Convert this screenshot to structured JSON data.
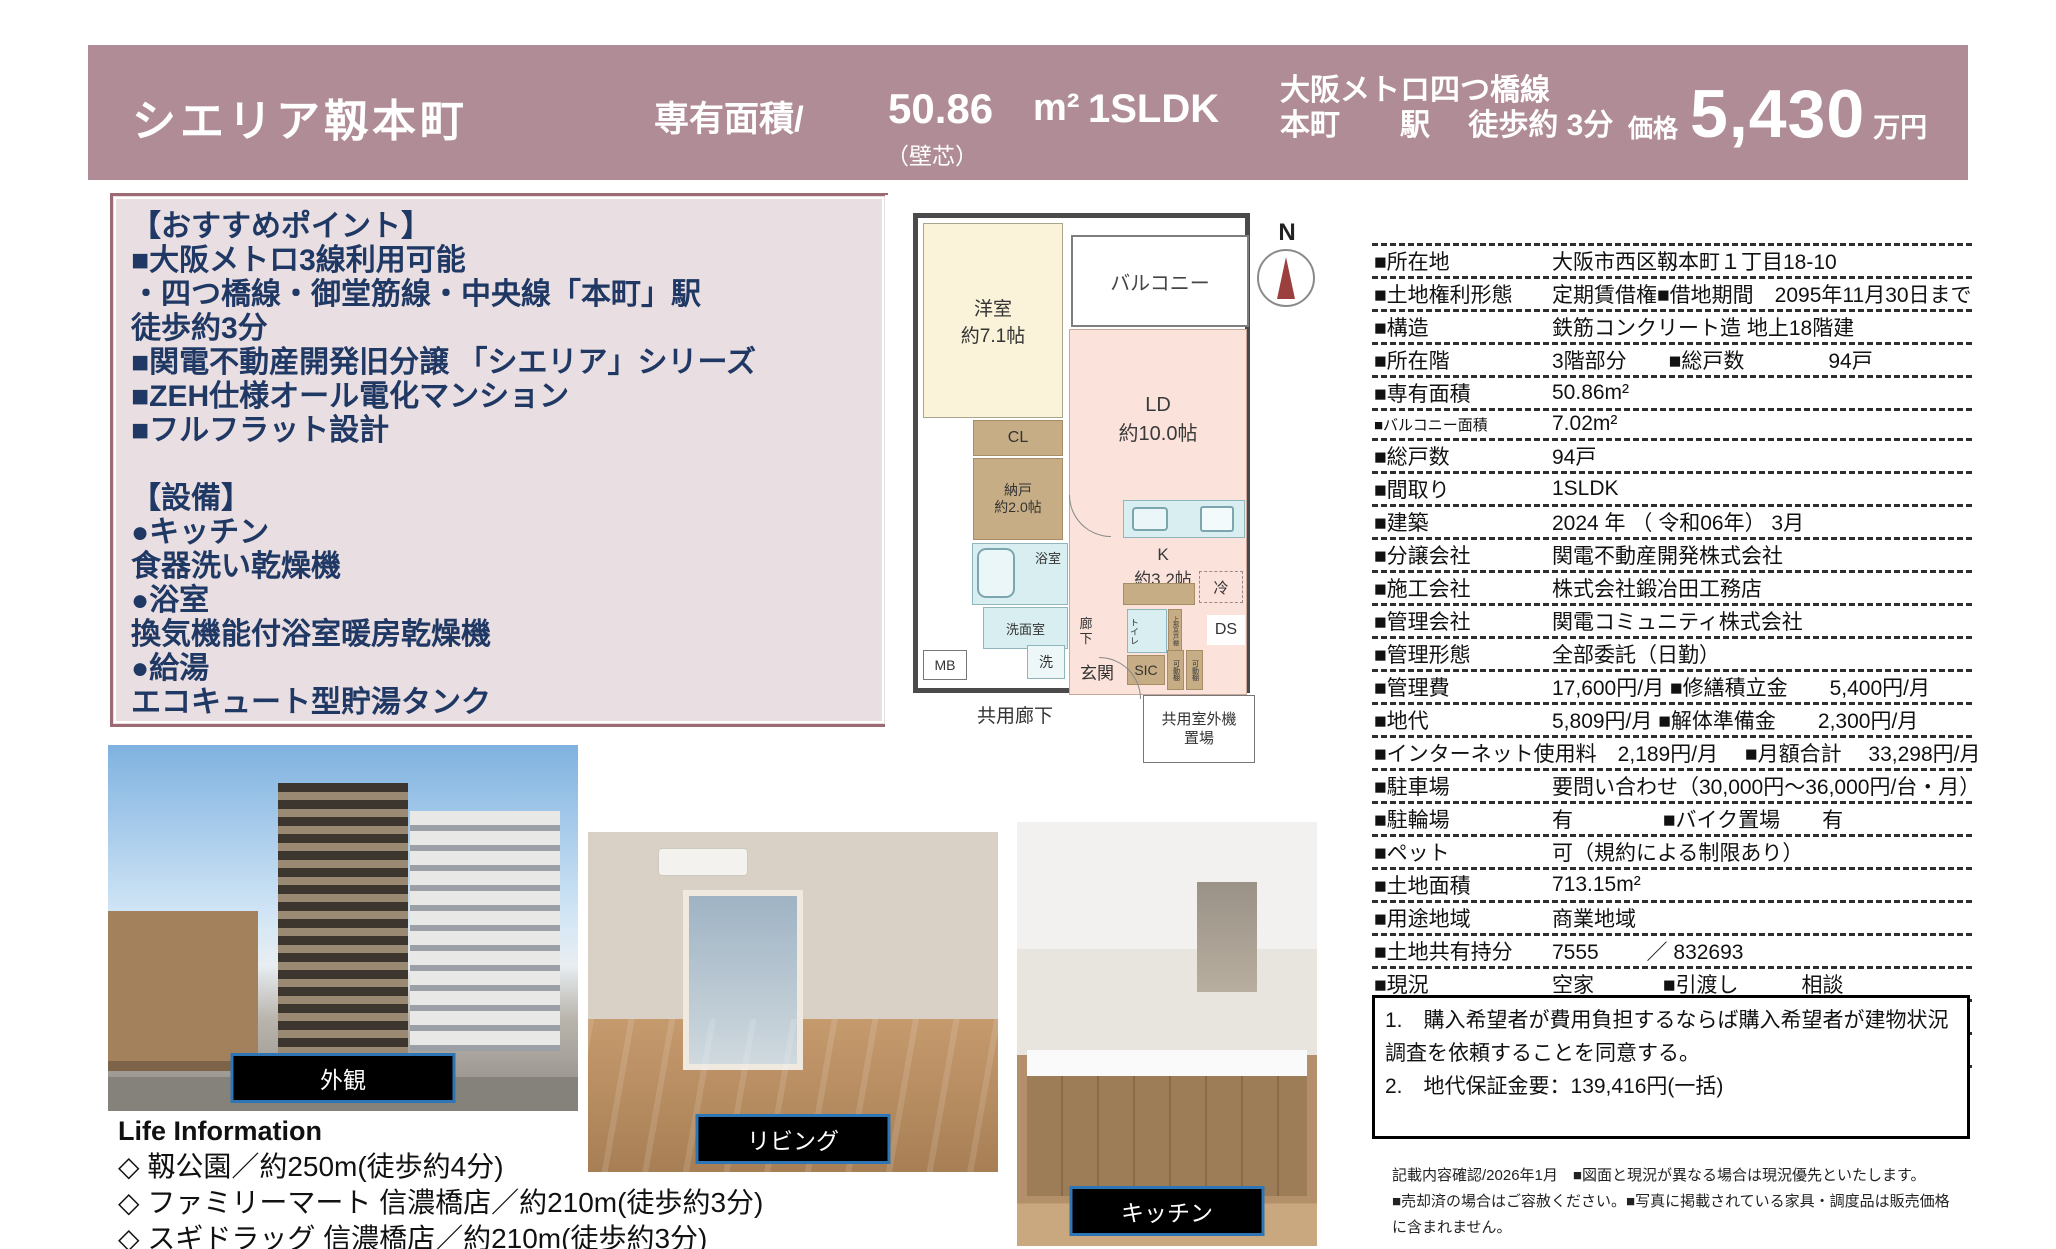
{
  "header": {
    "bg_color": "#b08d96",
    "title": "シエリア靱本町",
    "area_label": "専有面積/",
    "area_value": "50.86",
    "area_unit": "m²",
    "layout_type": "1SLDK",
    "area_note": "（壁芯）",
    "station_line1": "大阪メトロ四つ橋線",
    "station_line2": "本町　　駅　 徒歩約 3分",
    "price_label": "価格",
    "price_value": "5,430",
    "price_unit": "万円"
  },
  "highlights": {
    "lines": [
      "【おすすめポイント】",
      "■大阪メトロ3線利用可能",
      "・四つ橋線・御堂筋線・中央線「本町」駅",
      "徒歩約3分",
      "■関電不動産開発旧分譲 「シエリア」シリーズ",
      "■ZEH仕様オール電化マンション",
      "■フルフラット設計",
      "",
      "【設備】",
      "●キッチン",
      "食器洗い乾燥機",
      "●浴室",
      "換気機能付浴室暖房乾燥機",
      "●給湯",
      "エコキュート型貯湯タンク"
    ]
  },
  "floorplan": {
    "north_label": "N",
    "rooms": {
      "western_room": "洋室\n約7.1帖",
      "balcony": "バルコニー",
      "living_dining": "LD\n約10.0帖",
      "kitchen": "K\n約3.2帖",
      "fridge": "冷",
      "closet": "CL",
      "storage": "納戸\n約2.0帖",
      "bathroom": "浴室",
      "washroom": "洗面室",
      "hallway": "廊\n下",
      "toilet": "トイレ",
      "upper_shelf": "上部吊戸棚",
      "duct_space": "DS",
      "meter_box": "MB",
      "washer": "洗",
      "entrance": "玄関",
      "shoes_closet": "SIC",
      "movable_shelf1": "可動棚",
      "movable_shelf2": "可動棚",
      "common_corridor": "共用廊下",
      "outdoor_unit_space": "共用室外機\n置場"
    }
  },
  "photos": [
    {
      "label": "外観"
    },
    {
      "label": "リビング"
    },
    {
      "label": "キッチン"
    }
  ],
  "life_information": {
    "title": "Life Information",
    "items": [
      "◇ 靱公園／約250m(徒歩約4分)",
      "◇ ファミリーマート 信濃橋店／約210m(徒歩約3分)",
      "◇ スギドラッグ 信濃橋店／約210m(徒歩約3分)"
    ]
  },
  "details_table": {
    "rows": [
      {
        "label": "■所在地",
        "value": "大阪市西区靱本町１丁目18-10"
      },
      {
        "label": "■土地権利形態",
        "value": "定期賃借権■借地期間　2095年11月30日まで"
      },
      {
        "label": "■構造",
        "value": "鉄筋コンクリート造 地上18階建"
      },
      {
        "label": "■所在階",
        "value": "3階部分　　■総戸数　　　　94戸"
      },
      {
        "label": "■専有面積",
        "value": "50.86m²"
      },
      {
        "label": "■バルコニー面積",
        "small": true,
        "value": "7.02m²"
      },
      {
        "label": "■総戸数",
        "value": "94戸"
      },
      {
        "label": "■間取り",
        "value": "1SLDK"
      },
      {
        "label": "■建築",
        "value": "2024 年 （ 令和06年） 3月"
      },
      {
        "label": "■分譲会社",
        "value": "関電不動産開発株式会社"
      },
      {
        "label": "■施工会社",
        "value": "株式会社鍛冶田工務店"
      },
      {
        "label": "■管理会社",
        "value": "関電コミュニティ株式会社"
      },
      {
        "label": "■管理形態",
        "value": "全部委託（日勤）"
      },
      {
        "label": "■管理費",
        "value": "17,600円/月 ■修繕積立金　　5,400円/月"
      },
      {
        "label": "■地代",
        "value": "5,809円/月 ■解体準備金　　2,300円/月"
      },
      {
        "label": "■インターネット使用料　2,189円/月　 ■月額合計　 33,298円/月",
        "fullrow": true
      },
      {
        "label": "■駐車場",
        "value": "要問い合わせ（30,000円～36,000円/台・月）"
      },
      {
        "label": "■駐輪場",
        "value": "有　　　　 ■バイク置場　　有"
      },
      {
        "label": "■ペット",
        "value": "可（規約による制限あり）"
      },
      {
        "label": "■土地面積",
        "value": "713.15m²"
      },
      {
        "label": "■用途地域",
        "value": "商業地域"
      },
      {
        "label": "■土地共有持分",
        "value": "7555　　 ／ 832693"
      },
      {
        "label": "■現況",
        "value": "空家　　　 ■引渡し　　　相談"
      },
      {
        "label": "■建物状況調査について　　 備考1参照",
        "fullrow": true
      },
      {
        "label": "■備考",
        "value": ""
      }
    ]
  },
  "remarks": {
    "lines": [
      "1.　購入希望者が費用負担するならば購入希望者が建物状況調査を依頼することを同意する。",
      "2.　地代保証金要：139,416円(一括)"
    ]
  },
  "fine_print": {
    "lines": [
      "記載内容確認/2026年1月　■図面と現況が異なる場合は現況優先といたします。",
      "■売却済の場合はご容赦ください。■写真に掲載されている家具・調度品は販売価格に含まれません。"
    ]
  }
}
